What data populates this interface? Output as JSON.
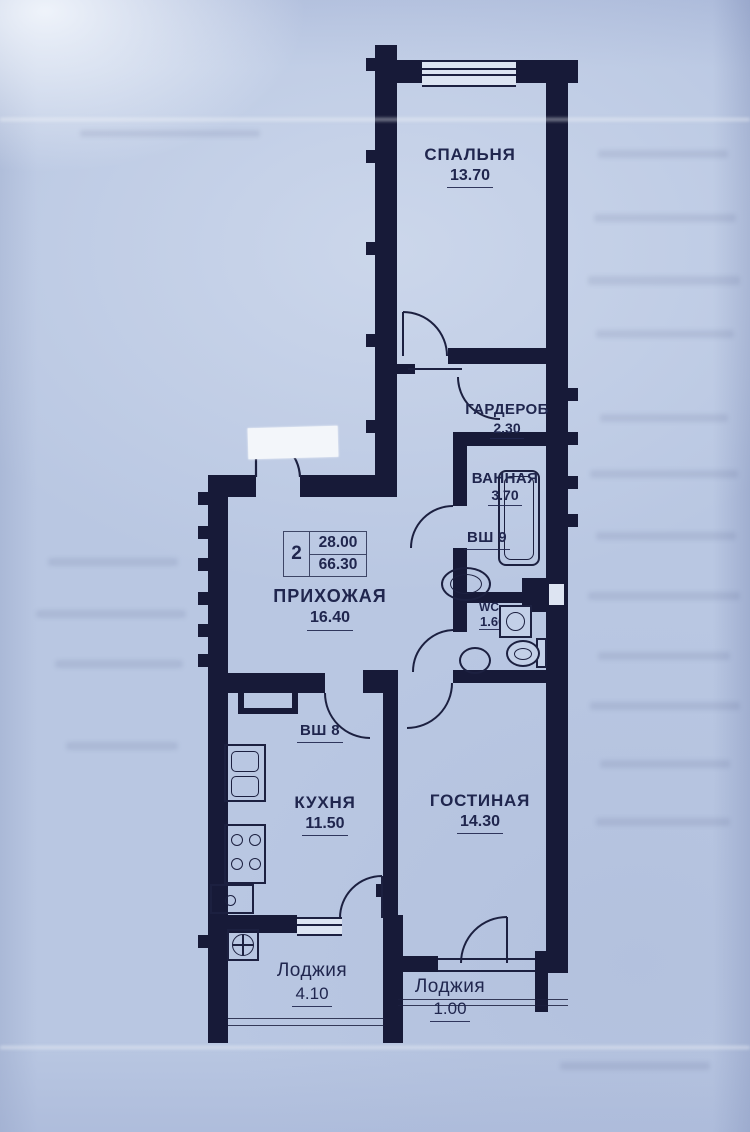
{
  "stamp": {
    "room_count": "2",
    "area_top": "28.00",
    "area_bottom": "66.30"
  },
  "rooms": [
    {
      "id": "bedroom",
      "name": "СПАЛЬНЯ",
      "area": "13.70"
    },
    {
      "id": "wardrobe",
      "name": "ГАРДЕРОБ",
      "area": "2.30"
    },
    {
      "id": "bathroom",
      "name": "ВАННАЯ",
      "area": "3.70"
    },
    {
      "id": "vent-shaft-9",
      "name": "ВШ 9",
      "area": ""
    },
    {
      "id": "wc",
      "name": "WC",
      "area": "1.60"
    },
    {
      "id": "hallway",
      "name": "ПРИХОЖАЯ",
      "area": "16.40"
    },
    {
      "id": "vent-shaft-8",
      "name": "ВШ 8",
      "area": ""
    },
    {
      "id": "kitchen",
      "name": "КУХНЯ",
      "area": "11.50"
    },
    {
      "id": "living-room",
      "name": "ГОСТИНАЯ",
      "area": "14.30"
    },
    {
      "id": "loggia-left",
      "name": "Лоджия",
      "area": "4.10"
    },
    {
      "id": "loggia-right",
      "name": "Лоджия",
      "area": "1.00"
    }
  ],
  "colors": {
    "ink": "#171a38",
    "paper": "#b9c7e2"
  }
}
